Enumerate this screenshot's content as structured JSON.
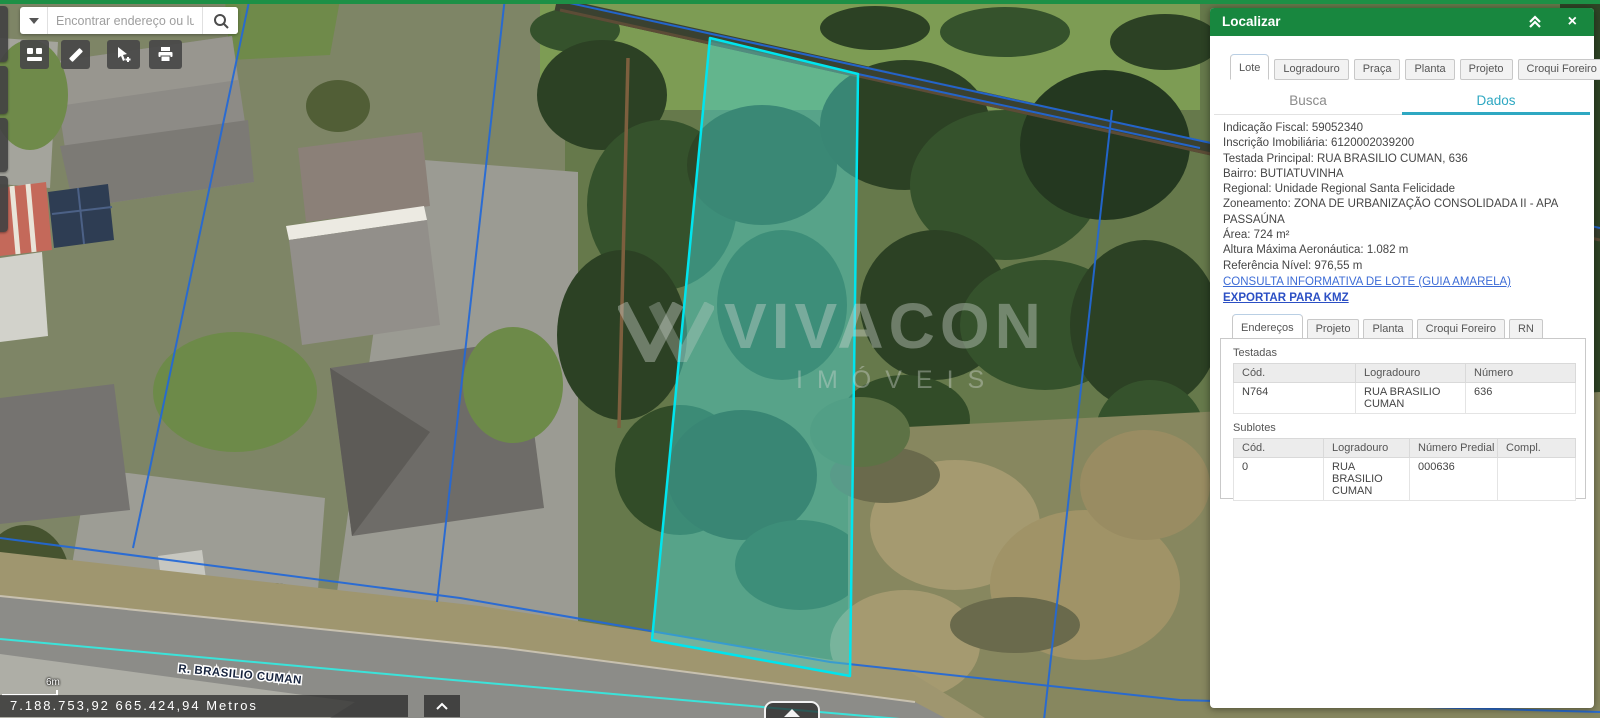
{
  "colors": {
    "top_bar": "#1D9046",
    "panel_header_green": "#18873F",
    "accent_teal": "#2FA8C2",
    "link_blue": "#3D6CD6",
    "lot_fill": "rgba(72,209,204,0.48)",
    "lot_stroke": "#00E5EE",
    "parcel_line_blue": "#2268D8",
    "street_line_cyan": "#3BE3DA"
  },
  "search": {
    "placeholder": "Encontrar endereço ou luga"
  },
  "toolbar": {
    "buttons": [
      "basemap-gallery",
      "measure",
      "select-features",
      "print"
    ]
  },
  "map": {
    "street_label": "R. BRASILIO CUMAN",
    "scale_label": "6m",
    "coordinates_label": "7.188.753,92 665.424,94 Metros",
    "watermark_title": "VIVACON",
    "watermark_subtitle": "IMÓVEIS"
  },
  "panel": {
    "title": "Localizar",
    "tabs": [
      "Lote",
      "Logradouro",
      "Praça",
      "Planta",
      "Projeto",
      "Croqui Foreiro"
    ],
    "active_tab": "Lote",
    "segments": [
      "Busca",
      "Dados"
    ],
    "active_segment": "Dados",
    "data_lines": [
      "Indicação Fiscal: 59052340",
      "Inscrição Imobiliária: 6120002039200",
      "Testada Principal: RUA BRASILIO CUMAN, 636",
      "Bairro: BUTIATUVINHA",
      "Regional: Unidade Regional Santa Felicidade",
      "Zoneamento: ZONA DE URBANIZAÇÃO CONSOLIDADA II - APA PASSAÚNA",
      "Área: 724 m²",
      "Altura Máxima Aeronáutica: 1.082 m",
      "Referência Nível: 976,55 m"
    ],
    "links": [
      "CONSULTA INFORMATIVA DE LOTE (GUIA AMARELA)",
      "EXPORTAR PARA KMZ"
    ],
    "inner_tabs": [
      "Endereços",
      "Projeto",
      "Planta",
      "Croqui Foreiro",
      "RN"
    ],
    "active_inner_tab": "Endereços",
    "testadas": {
      "title": "Testadas",
      "headers": [
        "Cód.",
        "Logradouro",
        "Número"
      ],
      "rows": [
        [
          "N764",
          "RUA BRASILIO CUMAN",
          "636"
        ]
      ]
    },
    "sublotes": {
      "title": "Sublotes",
      "headers": [
        "Cód.",
        "Logradouro",
        "Número Predial",
        "Compl."
      ],
      "rows": [
        [
          "0",
          "RUA BRASILIO CUMAN",
          "000636",
          ""
        ]
      ]
    }
  }
}
